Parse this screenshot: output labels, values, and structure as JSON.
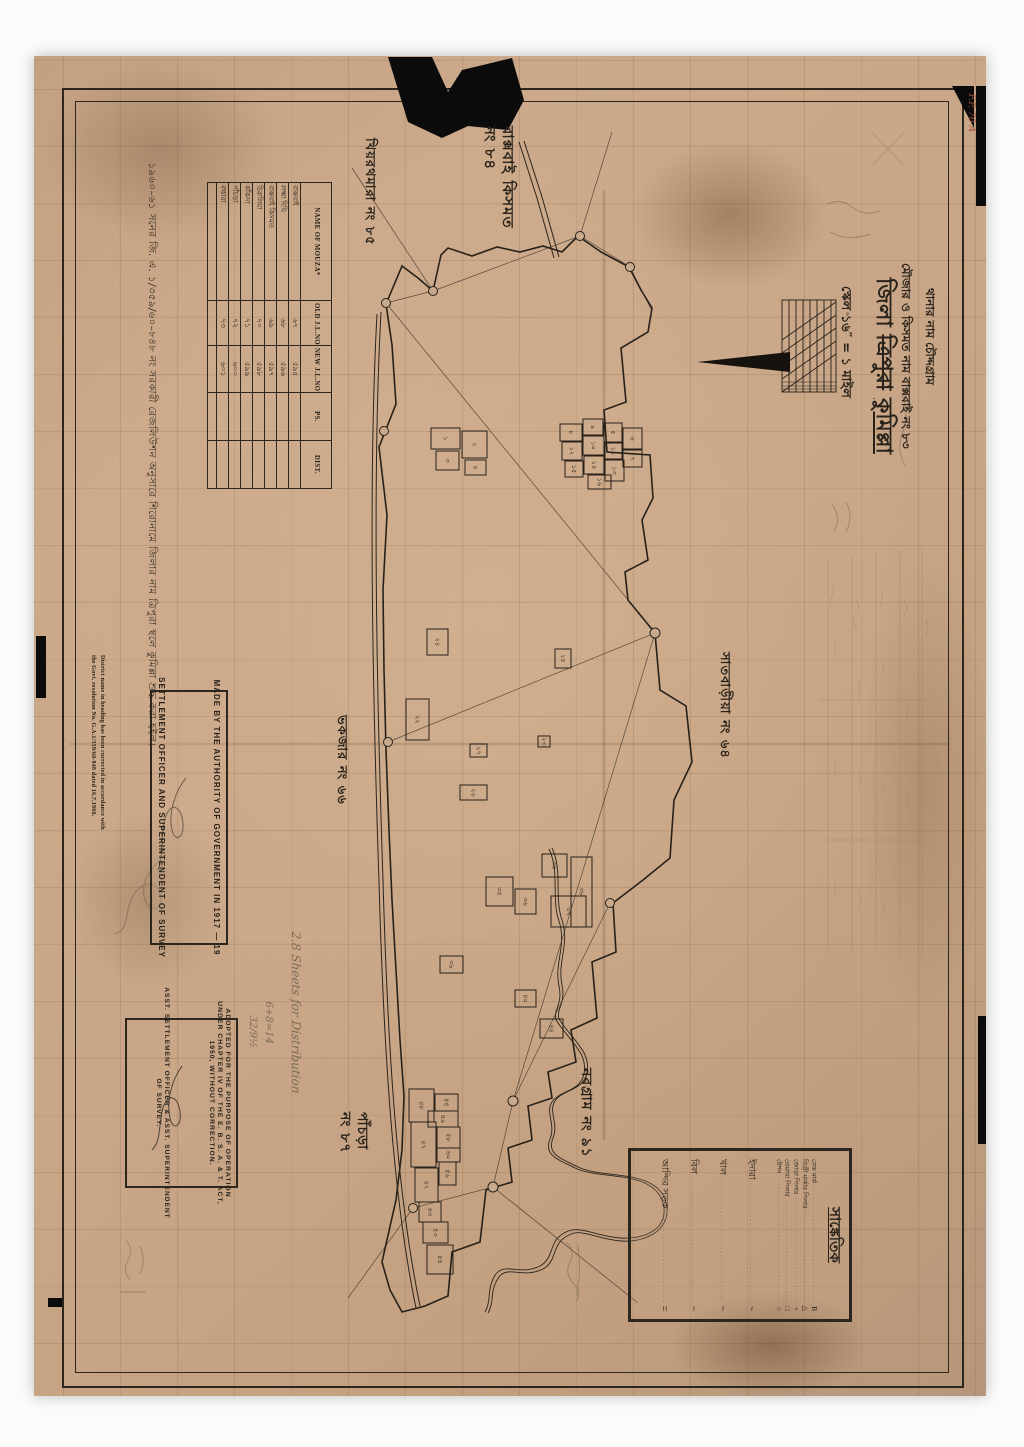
{
  "title_block": {
    "thana_line": "থানার নাম   চৌদ্দগ্রাম",
    "mouza_line": "মৌজার ও কিসমত নাম  বাক্সবাই  নং ৮৩",
    "district_label": "জিলা",
    "district_struck": "ত্রিপুরা",
    "district_new": "কুমিল্লা",
    "scale_line": "স্কেল ১৬″ = ১ মাইল"
  },
  "mouza_table": {
    "headers": [
      "NAME OF MOUZA*",
      "OLD J.L.NO",
      "NEW J.L.NO*",
      "PS.",
      "DIST."
    ],
    "rows": [
      {
        "name": "বাক্সবাই",
        "old": "৬৭",
        "new": "৫৯৫",
        "ps": "",
        "dist": ""
      },
      {
        "name": "লক্ষ্মা দিঘি",
        "old": "৬৮",
        "new": "৫৯৬",
        "ps": "",
        "dist": ""
      },
      {
        "name": "বাক্সবাই কিসমত",
        "old": "৬৯",
        "new": "৫৯৭",
        "ps": "",
        "dist": ""
      },
      {
        "name": "চিরুলিয়া",
        "old": "৭০",
        "new": "৫৯৮",
        "ps": "",
        "dist": ""
      },
      {
        "name": "কাঁকসা",
        "old": "৭১",
        "new": "৫৯৯",
        "ps": "",
        "dist": ""
      },
      {
        "name": "পাঁচড়া",
        "old": "৭২",
        "new": "৬০০",
        "ps": "",
        "dist": ""
      },
      {
        "name": "বহ্মারা",
        "old": "৭৩",
        "new": "৬০১",
        "ps": "",
        "dist": ""
      }
    ]
  },
  "authority_box": {
    "line1": "MADE BY THE AUTHORITY OF GOVERNMENT IN 1917 — 19",
    "line2": "SETTLEMENT OFFICER AND SUPERINTENDENT OF SURVEY"
  },
  "adopted_box": {
    "l1": "ADOPTED FOR THE PURPOSE OF OPERATION",
    "l2": "UNDER CHAPTER IV OF THE E. B. S. A. & T. ACT,",
    "l3": "1950, WITHOUT CORRECTION.",
    "l4": "ASST. SETTLEMENT OFFICER & ASST. SUPERINTENDENT",
    "l5": "OF SURVEY."
  },
  "correction_note": {
    "l1": "District name in heading has been corrected in accordance with",
    "l2": "the Govt. resolution No. G.A.1/359/60-848 dated 16.7.1960."
  },
  "marginal_note": {
    "text": "১৯৬০–৬১ সনের জি. এ. ১/৩৫৯/৬০–৮৪৮ নং সরকারী রেজলিউশন অনুসারে শিরোনামে জিলার নাম ত্রিপুরা স্থলে কুমিল্লা শুদ্ধ করা হইল।"
  },
  "legend": {
    "title": "সাঙ্কেতিক",
    "pillar_rows": [
      {
        "label": "বেঞ্চ মার্ক",
        "symbol": "B"
      },
      {
        "label": "ডিগ্রী মার্কার পিলার",
        "symbol": "△"
      },
      {
        "label": "জোড়া পিলার",
        "symbol": "+"
      },
      {
        "label": "তেমাথা পিলার",
        "symbol": "□"
      },
      {
        "label": "ষ্টেশন",
        "symbol": "○"
      }
    ],
    "feature_rows": [
      {
        "label": "ইদারা",
        "symbol": "~"
      },
      {
        "label": "খাল",
        "symbol": "~"
      },
      {
        "label": "বিল",
        "symbol": "~"
      },
      {
        "label": "আন্দির সড়ক",
        "symbol": "="
      }
    ]
  },
  "scale_bar": {
    "ticks_text": "১৬  ৮  ০"
  },
  "annotations": [
    {
      "x": 516,
      "y": 126,
      "size": 15,
      "lines": [
        "বাক্সবাই কিসমত",
        "নং ৮৪"
      ]
    },
    {
      "x": 376,
      "y": 138,
      "size": 13,
      "lines": [
        "খিয়রথমারা নং ৮৫"
      ]
    },
    {
      "x": 731,
      "y": 652,
      "size": 13,
      "lines": [
        "সাতবাড়ীয়া নং ৬৪"
      ]
    },
    {
      "x": 348,
      "y": 715,
      "size": 13,
      "lines": [
        "ভকজার নং ৬৬"
      ]
    },
    {
      "x": 594,
      "y": 1068,
      "size": 14,
      "lines": [
        "নবগ্রাম নং ৯১"
      ]
    },
    {
      "x": 370,
      "y": 1112,
      "size": 14,
      "lines": [
        "পাঁচড়া",
        "নং ৮৭"
      ]
    }
  ],
  "pencil_notes": [
    {
      "x": 302,
      "y": 932,
      "size": 12,
      "text": "2.8 Sheets for Distribution",
      "red": false
    },
    {
      "x": 274,
      "y": 1002,
      "size": 10,
      "text": "6+8=14",
      "red": false
    },
    {
      "x": 258,
      "y": 1016,
      "size": 10,
      "text": "32/9½",
      "red": false
    },
    {
      "x": 976,
      "y": 94,
      "size": 9,
      "text": "F.P. 70 A",
      "red": true
    }
  ],
  "plots": [
    {
      "x": 560,
      "y": 424,
      "w": 22,
      "h": 17,
      "label": "৮"
    },
    {
      "x": 583,
      "y": 419,
      "w": 20,
      "h": 16,
      "label": "৯"
    },
    {
      "x": 604,
      "y": 423,
      "w": 18,
      "h": 19,
      "label": "৫"
    },
    {
      "x": 623,
      "y": 428,
      "w": 19,
      "h": 21,
      "label": "৬"
    },
    {
      "x": 562,
      "y": 442,
      "w": 20,
      "h": 18,
      "label": "১২"
    },
    {
      "x": 583,
      "y": 436,
      "w": 21,
      "h": 19,
      "label": "১০"
    },
    {
      "x": 605,
      "y": 443,
      "w": 17,
      "h": 16,
      "label": "১১"
    },
    {
      "x": 623,
      "y": 450,
      "w": 19,
      "h": 17,
      "label": "৭"
    },
    {
      "x": 565,
      "y": 461,
      "w": 18,
      "h": 16,
      "label": "১৫"
    },
    {
      "x": 584,
      "y": 456,
      "w": 20,
      "h": 18,
      "label": "১৪"
    },
    {
      "x": 605,
      "y": 460,
      "w": 19,
      "h": 21,
      "label": "১৩"
    },
    {
      "x": 588,
      "y": 475,
      "w": 23,
      "h": 14,
      "label": "১৬"
    },
    {
      "x": 431,
      "y": 428,
      "w": 29,
      "h": 21,
      "label": "১"
    },
    {
      "x": 462,
      "y": 431,
      "w": 25,
      "h": 27,
      "label": "২"
    },
    {
      "x": 436,
      "y": 451,
      "w": 23,
      "h": 19,
      "label": "৩"
    },
    {
      "x": 465,
      "y": 460,
      "w": 21,
      "h": 15,
      "label": "৪"
    },
    {
      "x": 427,
      "y": 629,
      "w": 21,
      "h": 26,
      "label": "২৪"
    },
    {
      "x": 555,
      "y": 649,
      "w": 16,
      "h": 19,
      "label": "২৫"
    },
    {
      "x": 406,
      "y": 699,
      "w": 23,
      "h": 41,
      "label": "২২"
    },
    {
      "x": 538,
      "y": 736,
      "w": 12,
      "h": 11,
      "label": "২৩"
    },
    {
      "x": 460,
      "y": 785,
      "w": 27,
      "h": 15,
      "label": "২৬"
    },
    {
      "x": 470,
      "y": 744,
      "w": 17,
      "h": 13,
      "label": "২৭"
    },
    {
      "x": 542,
      "y": 854,
      "w": 25,
      "h": 23,
      "label": "৩৪"
    },
    {
      "x": 571,
      "y": 857,
      "w": 21,
      "h": 70,
      "label": "৩৮"
    },
    {
      "x": 486,
      "y": 877,
      "w": 27,
      "h": 29,
      "label": "৩৫"
    },
    {
      "x": 515,
      "y": 889,
      "w": 21,
      "h": 25,
      "label": "৩৬"
    },
    {
      "x": 551,
      "y": 896,
      "w": 35,
      "h": 31,
      "label": "৩৭"
    },
    {
      "x": 440,
      "y": 956,
      "w": 23,
      "h": 17,
      "label": "৩৯"
    },
    {
      "x": 515,
      "y": 990,
      "w": 21,
      "h": 17,
      "label": "৪০"
    },
    {
      "x": 540,
      "y": 1019,
      "w": 23,
      "h": 19,
      "label": "৪৪"
    },
    {
      "x": 409,
      "y": 1089,
      "w": 25,
      "h": 33,
      "label": "৪৮"
    },
    {
      "x": 435,
      "y": 1094,
      "w": 23,
      "h": 17,
      "label": "৫৫"
    },
    {
      "x": 428,
      "y": 1111,
      "w": 30,
      "h": 16,
      "label": "৫৯"
    },
    {
      "x": 411,
      "y": 1122,
      "w": 25,
      "h": 45,
      "label": "৪৭"
    },
    {
      "x": 437,
      "y": 1127,
      "w": 23,
      "h": 21,
      "label": "৫৮"
    },
    {
      "x": 437,
      "y": 1148,
      "w": 23,
      "h": 14,
      "label": "৬০"
    },
    {
      "x": 439,
      "y": 1162,
      "w": 17,
      "h": 23,
      "label": "৫৬"
    },
    {
      "x": 415,
      "y": 1168,
      "w": 23,
      "h": 34,
      "label": "৪২"
    },
    {
      "x": 419,
      "y": 1202,
      "w": 22,
      "h": 20,
      "label": "৪৩"
    },
    {
      "x": 423,
      "y": 1222,
      "w": 25,
      "h": 21,
      "label": "৫৩"
    },
    {
      "x": 427,
      "y": 1245,
      "w": 26,
      "h": 29,
      "label": "৫৪"
    }
  ]
}
